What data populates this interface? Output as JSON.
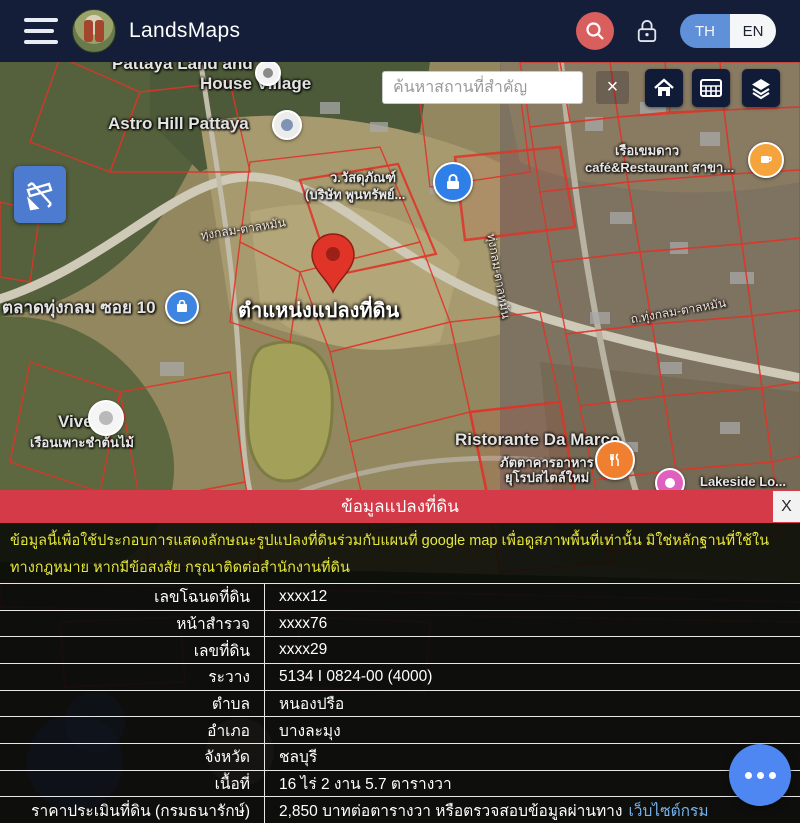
{
  "header": {
    "app_title": "LandsMaps",
    "lang": {
      "th": "TH",
      "en": "EN"
    }
  },
  "map": {
    "search_placeholder": "ค้นหาสถานที่สำคัญ",
    "clear_label": "×",
    "labels": {
      "pattaya_village_1": "Pattaya Land and",
      "pattaya_village_2": "House Village",
      "astro_hill": "Astro Hill Pattaya",
      "wasadu_1": "ว.วัสดุภัณฑ์",
      "wasadu_2": "(บริษัท พูนทรัพย์...",
      "cafe_1": "เรือเขมดาว",
      "cafe_2": "café&Restaurant สาขา...",
      "market": "ตลาดทุ่งกลม ซอย 10",
      "parcel_position": "ตำแหน่งแปลงที่ดิน",
      "vivero_1": "Vivero",
      "vivero_2": "เรือนเพาะชำต้นไม้",
      "damarco_1": "Ristorante Da Marco",
      "damarco_2": "ภัตตาคารอาหาร",
      "damarco_3": "ยุโรปสไตล์ใหม่",
      "lakeside": "Lakeside Lo...",
      "road_1": "ทุ่งกลม-ตาลหมัน",
      "road_2": "ทุ่งกลม-ตาลหมัน",
      "road_3": "ถ.ทุ่งกลม-ตาลหมัน"
    }
  },
  "panel": {
    "title": "ข้อมูลแปลงที่ดิน",
    "close_label": "X",
    "disclaimer": "ข้อมูลนี้เพื่อใช้ประกอบการแสดงลักษณะรูปแปลงที่ดินร่วมกับแผนที่ google map เพื่อดูสภาพพื้นที่เท่านั้น มิใช่หลักฐานที่ใช้ในทางกฎหมาย หากมีข้อสงสัย กรุณาติดต่อสำนักงานที่ดิน",
    "rows": [
      {
        "label": "เลขโฉนดที่ดิน",
        "value": "xxxx12"
      },
      {
        "label": "หน้าสำรวจ",
        "value": "xxxx76"
      },
      {
        "label": "เลขที่ดิน",
        "value": "xxxx29"
      },
      {
        "label": "ระวาง",
        "value": "5134 I 0824-00 (4000)"
      },
      {
        "label": "ตำบล",
        "value": "หนองปรือ"
      },
      {
        "label": "อำเภอ",
        "value": "บางละมุง"
      },
      {
        "label": "จังหวัด",
        "value": "ชลบุรี"
      },
      {
        "label": "เนื้อที่",
        "value": "16 ไร่ 2 งาน 5.7 ตารางวา"
      },
      {
        "label": "ราคาประเมินที่ดิน (กรมธนารักษ์)",
        "value": "2,850 บาทต่อตารางวา หรือตรวจสอบข้อมูลผ่านทาง",
        "link": "เว็บไซต์กรม"
      }
    ]
  },
  "colors": {
    "header_bg": "#141e38",
    "banner_red": "#d43a47",
    "search_fab_red": "#d95f5f",
    "toggle_blue": "#6090d8",
    "draw_btn_blue": "#4d7bd0",
    "disclaimer_yellow": "#e6e83a",
    "link_blue": "#78b0e8",
    "fab_blue": "#4e86f2",
    "parcel_line_red": "#e03428"
  }
}
